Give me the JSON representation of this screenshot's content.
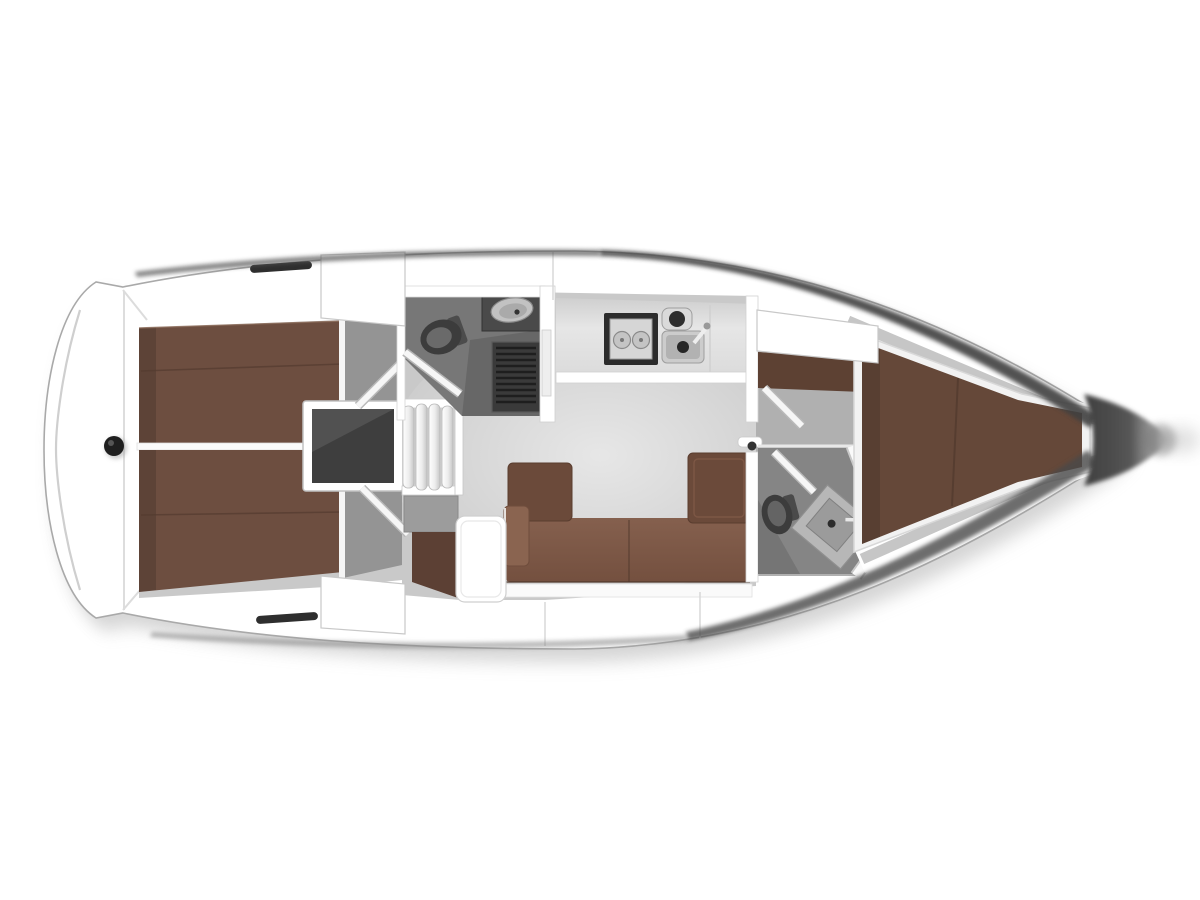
{
  "figure": {
    "kind": "yacht-interior-floorplan-top-view",
    "orientation": "bow-right-stern-left"
  },
  "palette": {
    "background": "#ffffff",
    "hull_white": "#ffffff",
    "hull_outline": "#a9a9a9",
    "hull_edge_dark": "#3f3f3f",
    "deck_seam": "#d6d6d6",
    "floor_light": "#c9c9c9",
    "floor_forward": "#b0b0b0",
    "berth_brown": "#6d4e40",
    "berth_brown_fwd": "#654839",
    "berth_seam": "#543b2f",
    "settee_brown": "#7a5544",
    "settee_back_brown": "#6b4a3a",
    "armrest_brown": "#8a6450",
    "nav_seat_brown": "#5c4034",
    "shelf_brown": "#5d4133",
    "engine_dark": "#3e3e3e",
    "head_floor": "#777777",
    "head_floor_fwd": "#858585",
    "grate_dark": "#3a3a3a",
    "fixture_dark": "#3c3c3c",
    "counter_dark": "#4a4a4a",
    "galley_counter": "#e2e2e2",
    "sink_gray": "#cccccc",
    "vestibule_gray": "#949494",
    "hatch_slot": "#2e2e2e",
    "stern_dot": "#1f1f1f",
    "bow_cone": "#3f3f3f"
  },
  "regions": [
    {
      "id": "swim-platform",
      "label": "swim platform and transom"
    },
    {
      "id": "aft-cabin-port",
      "label": "port aft double-berth cabin"
    },
    {
      "id": "aft-cabin-starboard",
      "label": "starboard aft double-berth cabin"
    },
    {
      "id": "engine-compartment",
      "label": "engine compartment"
    },
    {
      "id": "companionway-steps",
      "label": "companionway steps"
    },
    {
      "id": "aft-head",
      "label": "aft head with toilet, basin and shower grate"
    },
    {
      "id": "galley",
      "label": "galley with stove and twin sinks"
    },
    {
      "id": "salon",
      "label": "salon settee"
    },
    {
      "id": "nav-station",
      "label": "navigation seat and table"
    },
    {
      "id": "passageway",
      "label": "forward passageway with doors"
    },
    {
      "id": "forward-head",
      "label": "forward head with toilet and angled basin"
    },
    {
      "id": "forward-cabin",
      "label": "forward V-berth cabin"
    },
    {
      "id": "bow",
      "label": "bow"
    }
  ]
}
